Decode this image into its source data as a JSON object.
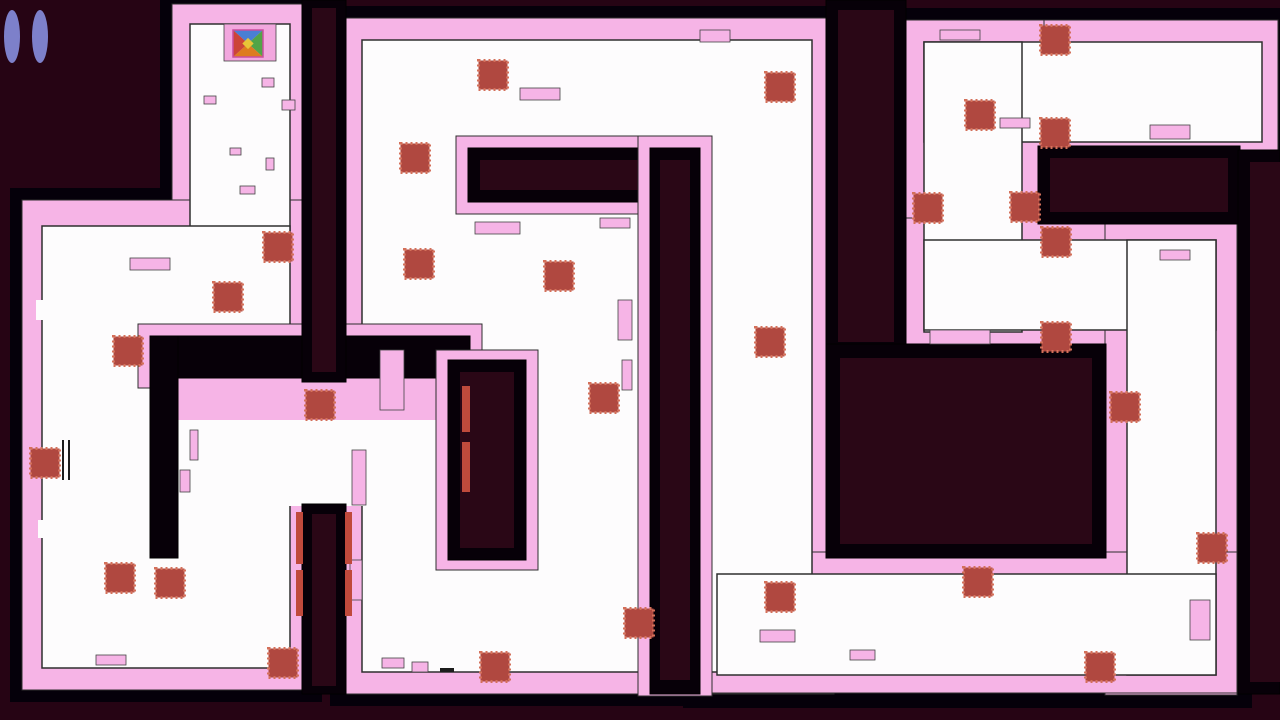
{
  "screen": {
    "kind": "maze-game-level"
  },
  "colors": {
    "bg": "#260414",
    "halo": "#05000a",
    "pink": "#f6b4e6",
    "white": "#fdfcfd",
    "outline": "#2e2e2e",
    "wall_black": "#070008",
    "wall_core": "#2a0716",
    "red_fill": "#b04840",
    "red_fringe": "#d4705a",
    "strip_red": "#c04a3c",
    "pause_fill": "#7d80ca",
    "start_cell": "#f2a7de",
    "player_border": "#c94f9e",
    "player_n": "#4a7fd4",
    "player_e": "#52a447",
    "player_s": "#de7b1f",
    "player_w": "#cc4437",
    "player_center": "#e8c437",
    "noise_dark": "#1c1c1c"
  },
  "hud": {
    "pause_icon": "pause-icon",
    "bars": 2
  },
  "player": {
    "x": 233,
    "y": 30,
    "w": 30,
    "h": 27,
    "start_cell": [
      224,
      24,
      52,
      37
    ]
  },
  "maze": {
    "halo": [
      [
        160,
        0,
        160,
        234
      ],
      [
        10,
        188,
        312,
        514
      ],
      [
        138,
        364,
        346,
        156
      ],
      [
        330,
        6,
        516,
        700
      ],
      [
        890,
        8,
        398,
        156
      ],
      [
        890,
        8,
        168,
        356
      ],
      [
        890,
        206,
        362,
        158
      ],
      [
        1093,
        206,
        158,
        501
      ],
      [
        683,
        540,
        569,
        168
      ]
    ],
    "pink": [
      [
        172,
        4,
        136,
        218
      ],
      [
        22,
        200,
        288,
        490
      ],
      [
        342,
        18,
        492,
        676
      ],
      [
        902,
        20,
        376,
        132
      ],
      [
        902,
        20,
        142,
        332
      ],
      [
        902,
        218,
        336,
        132
      ],
      [
        1105,
        218,
        132,
        477
      ],
      [
        695,
        552,
        542,
        141
      ]
    ],
    "white": [
      [
        190,
        24,
        100,
        210
      ],
      [
        42,
        226,
        248,
        442
      ],
      [
        362,
        40,
        450,
        632
      ],
      [
        924,
        42,
        338,
        100
      ],
      [
        924,
        42,
        98,
        290
      ],
      [
        924,
        240,
        292,
        90
      ],
      [
        1127,
        240,
        89,
        435
      ],
      [
        717,
        574,
        499,
        101
      ]
    ],
    "intrusions": [
      {
        "pink": [
          138,
          324,
          344,
          64
        ]
      },
      {
        "pink": [
          150,
          378,
          322,
          44
        ]
      },
      {
        "white": [
          178,
          420,
          286,
          86
        ]
      },
      {
        "black": [
          150,
          336,
          320,
          42
        ]
      },
      {
        "black": [
          150,
          336,
          28,
          222
        ]
      },
      {
        "pink": [
          436,
          350,
          102,
          220
        ],
        "black": [
          448,
          360,
          78,
          200
        ],
        "core": [
          460,
          372,
          54,
          176
        ]
      },
      {
        "pink": [
          456,
          136,
          256,
          78
        ],
        "black": [
          468,
          148,
          232,
          54
        ],
        "core": [
          480,
          160,
          208,
          30
        ]
      },
      {
        "pink": [
          638,
          136,
          74,
          560
        ],
        "black": [
          650,
          148,
          50,
          546
        ],
        "core": [
          660,
          160,
          30,
          520
        ]
      },
      {
        "black": [
          302,
          0,
          44,
          382
        ],
        "core": [
          312,
          8,
          24,
          364
        ]
      },
      {
        "black": [
          302,
          504,
          44,
          190
        ],
        "core": [
          312,
          514,
          24,
          172
        ]
      },
      {
        "black": [
          826,
          0,
          80,
          352
        ],
        "core": [
          838,
          10,
          56,
          332
        ]
      },
      {
        "black": [
          826,
          344,
          280,
          214
        ],
        "core": [
          840,
          358,
          252,
          186
        ]
      },
      {
        "black": [
          1038,
          146,
          202,
          78
        ],
        "core": [
          1050,
          158,
          178,
          54
        ]
      },
      {
        "black": [
          1238,
          150,
          42,
          544
        ],
        "core": [
          1250,
          162,
          30,
          520
        ]
      }
    ],
    "noise": [
      [
        208,
        42,
        8,
        14,
        "white"
      ],
      [
        220,
        68,
        6,
        10,
        "white"
      ],
      [
        204,
        96,
        12,
        8,
        "pink"
      ],
      [
        262,
        78,
        12,
        9,
        "pink"
      ],
      [
        282,
        100,
        13,
        10,
        "pink"
      ],
      [
        196,
        128,
        7,
        16,
        "white"
      ],
      [
        230,
        148,
        11,
        7,
        "pink"
      ],
      [
        266,
        158,
        8,
        12,
        "pink"
      ],
      [
        240,
        186,
        15,
        8,
        "pink"
      ],
      [
        210,
        124,
        5,
        9,
        "white"
      ],
      [
        36,
        300,
        7,
        20,
        "white"
      ],
      [
        130,
        258,
        40,
        12,
        "pink"
      ],
      [
        60,
        410,
        6,
        16,
        "white"
      ],
      [
        38,
        520,
        8,
        18,
        "white"
      ],
      [
        140,
        618,
        7,
        14,
        "white"
      ],
      [
        96,
        655,
        30,
        10,
        "pink"
      ],
      [
        190,
        430,
        8,
        30,
        "pink"
      ],
      [
        180,
        470,
        10,
        22,
        "pink"
      ],
      [
        62,
        440,
        2,
        40,
        "dark"
      ],
      [
        68,
        440,
        2,
        40,
        "dark"
      ],
      [
        475,
        222,
        45,
        12,
        "pink"
      ],
      [
        600,
        218,
        30,
        10,
        "pink"
      ],
      [
        380,
        350,
        24,
        60,
        "pink"
      ],
      [
        352,
        450,
        14,
        55,
        "pink"
      ],
      [
        350,
        560,
        12,
        40,
        "pink"
      ],
      [
        382,
        658,
        22,
        10,
        "pink"
      ],
      [
        412,
        662,
        16,
        10,
        "pink"
      ],
      [
        440,
        668,
        14,
        4,
        "dark"
      ],
      [
        520,
        88,
        40,
        12,
        "pink"
      ],
      [
        700,
        30,
        30,
        12,
        "pink"
      ],
      [
        618,
        300,
        14,
        40,
        "pink"
      ],
      [
        622,
        360,
        10,
        30,
        "pink"
      ],
      [
        940,
        30,
        40,
        10,
        "pink"
      ],
      [
        1150,
        125,
        40,
        14,
        "pink"
      ],
      [
        1000,
        118,
        30,
        10,
        "pink"
      ],
      [
        930,
        330,
        60,
        14,
        "pink"
      ],
      [
        760,
        630,
        35,
        12,
        "pink"
      ],
      [
        850,
        650,
        25,
        10,
        "pink"
      ],
      [
        1160,
        250,
        30,
        10,
        "pink"
      ],
      [
        1190,
        600,
        20,
        40,
        "pink"
      ]
    ],
    "red_strips": [
      [
        296,
        512,
        7,
        52
      ],
      [
        296,
        570,
        7,
        46
      ],
      [
        345,
        512,
        7,
        52
      ],
      [
        345,
        570,
        7,
        46
      ],
      [
        462,
        386,
        8,
        46
      ],
      [
        462,
        442,
        8,
        50
      ]
    ]
  },
  "collectibles": {
    "size": 29,
    "positions": [
      [
        278,
        247
      ],
      [
        228,
        297
      ],
      [
        128,
        351
      ],
      [
        45,
        463
      ],
      [
        120,
        578
      ],
      [
        170,
        583
      ],
      [
        283,
        663
      ],
      [
        493,
        75
      ],
      [
        780,
        87
      ],
      [
        415,
        158
      ],
      [
        419,
        264
      ],
      [
        559,
        276
      ],
      [
        320,
        405
      ],
      [
        604,
        398
      ],
      [
        770,
        342
      ],
      [
        495,
        667
      ],
      [
        639,
        623
      ],
      [
        780,
        597
      ],
      [
        1055,
        40
      ],
      [
        980,
        115
      ],
      [
        1055,
        133
      ],
      [
        928,
        208
      ],
      [
        1025,
        207
      ],
      [
        1056,
        242
      ],
      [
        1056,
        337
      ],
      [
        1125,
        407
      ],
      [
        1212,
        548
      ],
      [
        978,
        582
      ],
      [
        1100,
        667
      ]
    ]
  }
}
